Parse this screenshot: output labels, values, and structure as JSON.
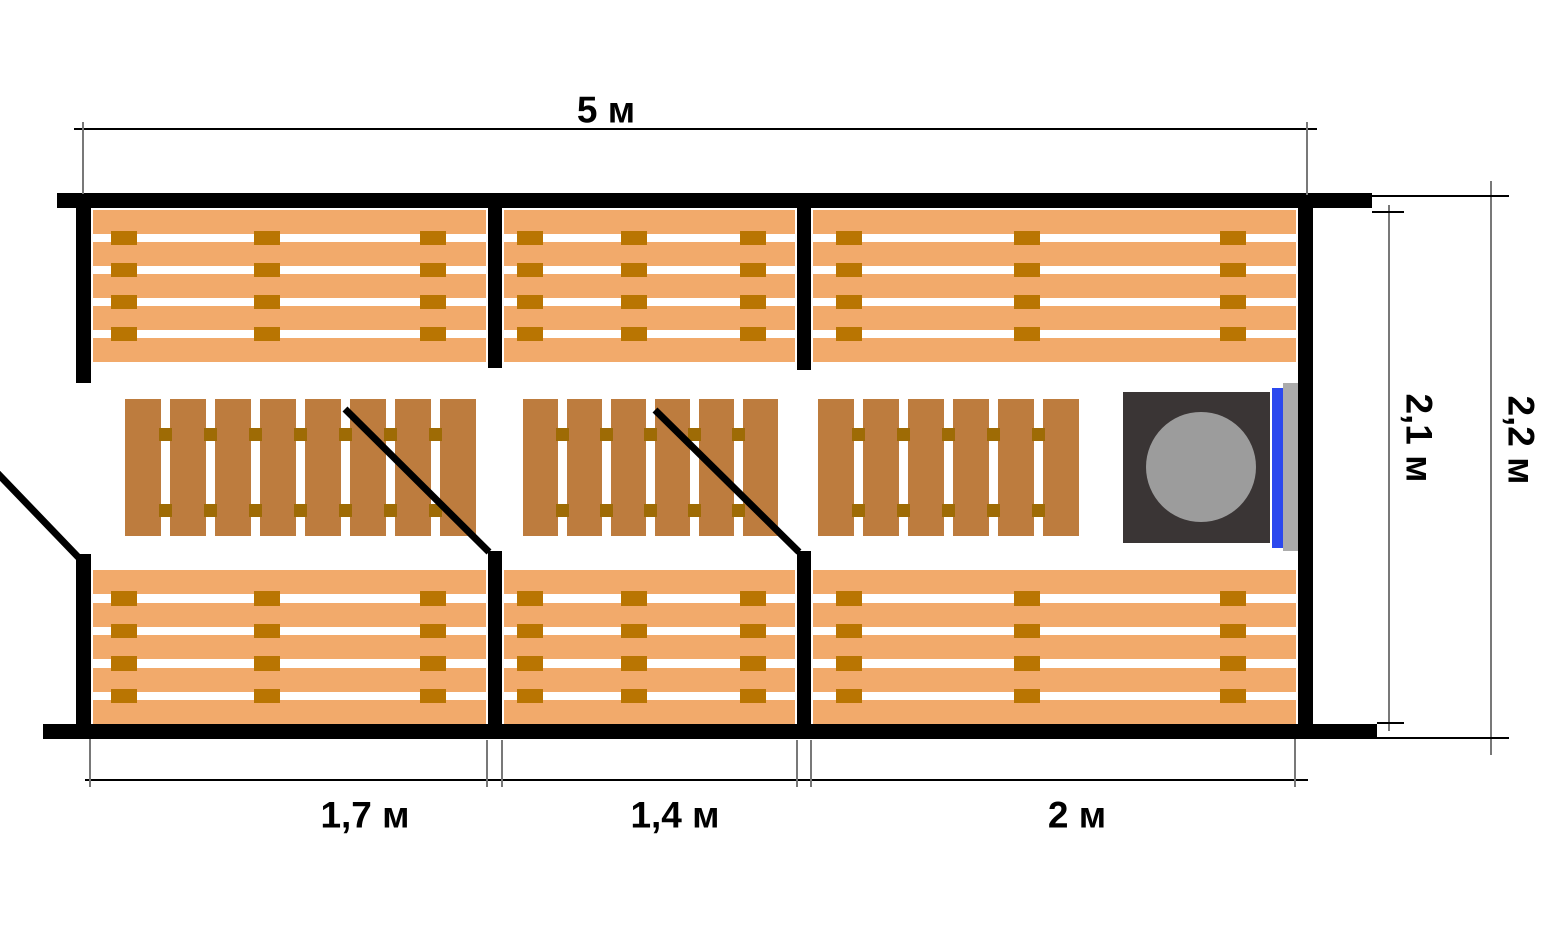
{
  "diagram": {
    "type": "floor-plan",
    "subject": "sauna-three-rooms-top-view",
    "dimension_labels": {
      "total_width": "5 м",
      "room1_width": "1,7 м",
      "room2_width": "1,4 м",
      "room3_width": "2 м",
      "inner_depth": "2,1 м",
      "outer_depth": "2,2 м"
    }
  },
  "colors": {
    "wall": "#000000",
    "bench_plank": "#f2aa6b",
    "bench_connector": "#b97502",
    "duckboard_slat": "#bd7c3e",
    "duckboard_connector": "#9e6b05",
    "stove_body": "#3a3535",
    "stove_circle": "#9c9c9c",
    "tank_blue": "#2b48ee",
    "masonry_gray": "#ababab",
    "dim_line": "#000000",
    "ext_line": "#787878",
    "door_line": "#000000"
  },
  "layout": {
    "canvas": {
      "w": 1546,
      "h": 928
    },
    "walls": [
      {
        "name": "wall-exterior-top",
        "x": 57,
        "y": 193,
        "w": 1315,
        "h": 15
      },
      {
        "name": "wall-exterior-bottom",
        "x": 43,
        "y": 724,
        "w": 1334,
        "h": 15
      },
      {
        "name": "wall-left-upper-segment",
        "x": 76,
        "y": 208,
        "w": 15,
        "h": 175
      },
      {
        "name": "wall-left-lower-segment",
        "x": 76,
        "y": 554,
        "w": 15,
        "h": 170
      },
      {
        "name": "wall-exterior-right",
        "x": 1298,
        "y": 208,
        "w": 15,
        "h": 516
      },
      {
        "name": "partition-1-upper",
        "x": 488,
        "y": 208,
        "w": 14,
        "h": 160
      },
      {
        "name": "partition-1-lower",
        "x": 488,
        "y": 551,
        "w": 14,
        "h": 173
      },
      {
        "name": "partition-2-upper",
        "x": 797,
        "y": 208,
        "w": 14,
        "h": 162
      },
      {
        "name": "partition-2-lower",
        "x": 797,
        "y": 551,
        "w": 14,
        "h": 173
      }
    ],
    "benches": [
      {
        "name": "bench-upper-room-1",
        "x": 93,
        "y": 210,
        "w": 393,
        "h": 152
      },
      {
        "name": "bench-upper-room-2",
        "x": 504,
        "y": 210,
        "w": 291,
        "h": 152
      },
      {
        "name": "bench-upper-room-3",
        "x": 813,
        "y": 210,
        "w": 483,
        "h": 152
      },
      {
        "name": "bench-lower-room-1",
        "x": 93,
        "y": 570,
        "w": 393,
        "h": 154
      },
      {
        "name": "bench-lower-room-2",
        "x": 504,
        "y": 570,
        "w": 291,
        "h": 154
      },
      {
        "name": "bench-lower-room-3",
        "x": 813,
        "y": 570,
        "w": 483,
        "h": 154
      }
    ],
    "bench_style": {
      "planks": 5,
      "plank_h": 24,
      "connector_w": 26,
      "connector_fracs": [
        0.05,
        0.44,
        0.89
      ]
    },
    "duckboards": [
      {
        "name": "duckboard-room-1",
        "x": 125,
        "y": 399,
        "h": 137,
        "slats": 8,
        "slat_w": 36,
        "gap": 9
      },
      {
        "name": "duckboard-room-2",
        "x": 523,
        "y": 399,
        "h": 137,
        "slats": 6,
        "slat_w": 35,
        "gap": 9
      },
      {
        "name": "duckboard-room-3",
        "x": 818,
        "y": 399,
        "h": 137,
        "slats": 6,
        "slat_w": 36,
        "gap": 9
      }
    ],
    "duckboard_connector": {
      "size": 13,
      "rows_y": [
        29,
        105
      ]
    },
    "stove": {
      "body": {
        "name": "stove-body",
        "x": 1123,
        "y": 392,
        "w": 147,
        "h": 151
      },
      "circle": {
        "name": "stove-heater-circle",
        "x": 1146,
        "y": 412,
        "w": 110,
        "h": 110
      },
      "tank": {
        "name": "water-tank-strip",
        "x": 1272,
        "y": 388,
        "w": 11,
        "h": 160
      },
      "masonry": {
        "name": "masonry-screen",
        "x": 1283,
        "y": 383,
        "w": 15,
        "h": 168
      }
    },
    "doors": [
      {
        "name": "door-swing-entrance",
        "x1": -20,
        "y1": 455,
        "x2": 79,
        "y2": 558
      },
      {
        "name": "door-swing-room1-room2",
        "x1": 345,
        "y1": 409,
        "x2": 489,
        "y2": 552
      },
      {
        "name": "door-swing-room2-room3",
        "x1": 655,
        "y1": 410,
        "x2": 799,
        "y2": 552
      }
    ],
    "door_stroke": 7,
    "dim_hlines": [
      {
        "name": "dimension-line-total-width",
        "x": 74,
        "y": 128,
        "len": 1243
      },
      {
        "name": "dimension-line-bottom-rooms",
        "x": 85,
        "y": 779,
        "len": 1223
      }
    ],
    "dim_vlines": [
      {
        "name": "dimension-line-inner-depth",
        "x": 1388,
        "y": 205,
        "len": 526
      },
      {
        "name": "dimension-line-outer-depth",
        "x": 1490,
        "y": 181,
        "len": 574
      }
    ],
    "ext_vlines": [
      {
        "name": "extension-top-left",
        "x": 82,
        "y": 122,
        "len": 72
      },
      {
        "name": "extension-top-right",
        "x": 1306,
        "y": 122,
        "len": 73
      },
      {
        "name": "extension-bottom-left",
        "x": 89,
        "y": 739,
        "len": 48
      },
      {
        "name": "extension-partition1-left",
        "x": 486,
        "y": 740,
        "len": 47
      },
      {
        "name": "extension-partition1-right",
        "x": 501,
        "y": 740,
        "len": 47
      },
      {
        "name": "extension-partition2-left",
        "x": 796,
        "y": 740,
        "len": 47
      },
      {
        "name": "extension-partition2-right",
        "x": 810,
        "y": 740,
        "len": 47
      },
      {
        "name": "extension-bottom-right",
        "x": 1294,
        "y": 739,
        "len": 48
      }
    ],
    "ext_hlines": [
      {
        "name": "extension-inner-depth-top",
        "x": 1372,
        "y": 211,
        "len": 32
      },
      {
        "name": "extension-inner-depth-bottom",
        "x": 1377,
        "y": 722,
        "len": 27
      },
      {
        "name": "extension-outer-depth-top",
        "x": 1372,
        "y": 195,
        "len": 137
      },
      {
        "name": "extension-outer-depth-bottom",
        "x": 1377,
        "y": 737,
        "len": 132
      }
    ],
    "labels_pos": {
      "total_width": {
        "x": 606,
        "y": 110,
        "rot": false
      },
      "room1_width": {
        "x": 365,
        "y": 815,
        "rot": false
      },
      "room2_width": {
        "x": 675,
        "y": 815,
        "rot": false
      },
      "room3_width": {
        "x": 1077,
        "y": 815,
        "rot": false
      },
      "inner_depth": {
        "x": 1419,
        "y": 438,
        "rot": true
      },
      "outer_depth": {
        "x": 1521,
        "y": 440,
        "rot": true
      }
    }
  }
}
